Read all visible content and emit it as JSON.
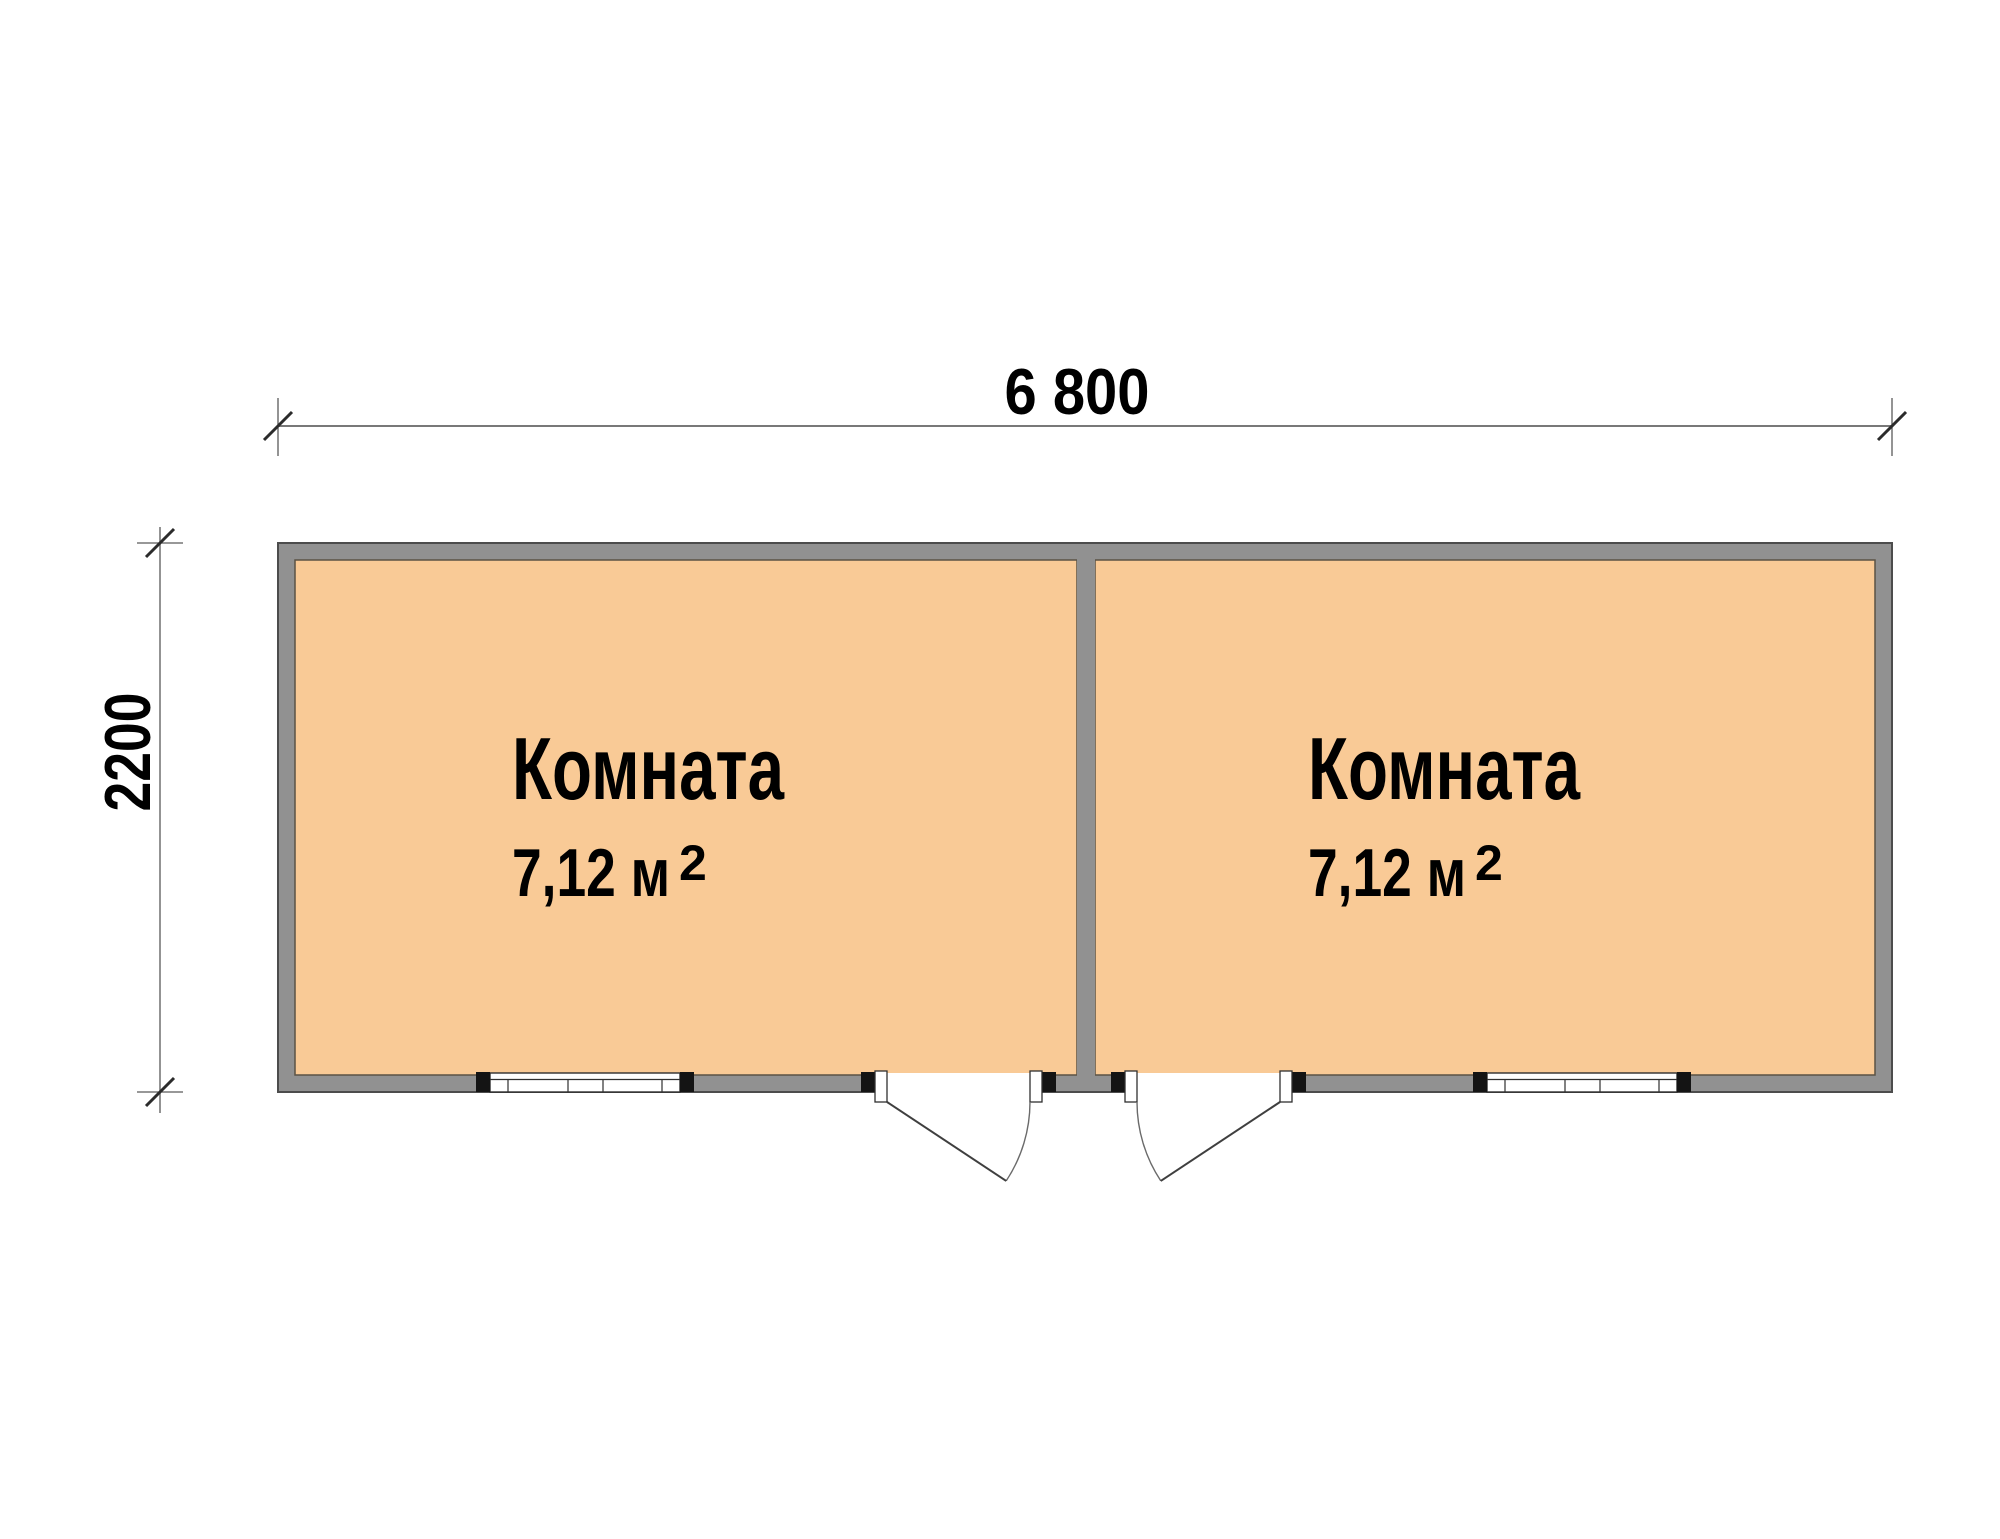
{
  "plan": {
    "type": "floor-plan",
    "width_dimension": "6 800",
    "height_dimension": "2200",
    "rooms": [
      {
        "label": "Комната",
        "area": "7,12 м",
        "area_superscript": "2"
      },
      {
        "label": "Комната",
        "area": "7,12 м",
        "area_superscript": "2"
      }
    ],
    "colors": {
      "background": "#ffffff",
      "room_fill": "#f9ca96",
      "wall_fill": "#919191",
      "wall_outline": "#4c4c4c",
      "opening_fill": "#ffffff",
      "symbol_line": "#2f2f2f",
      "dimension_line": "#787878",
      "tick_stroke": "#2b2b2b",
      "text": "#000000"
    }
  }
}
